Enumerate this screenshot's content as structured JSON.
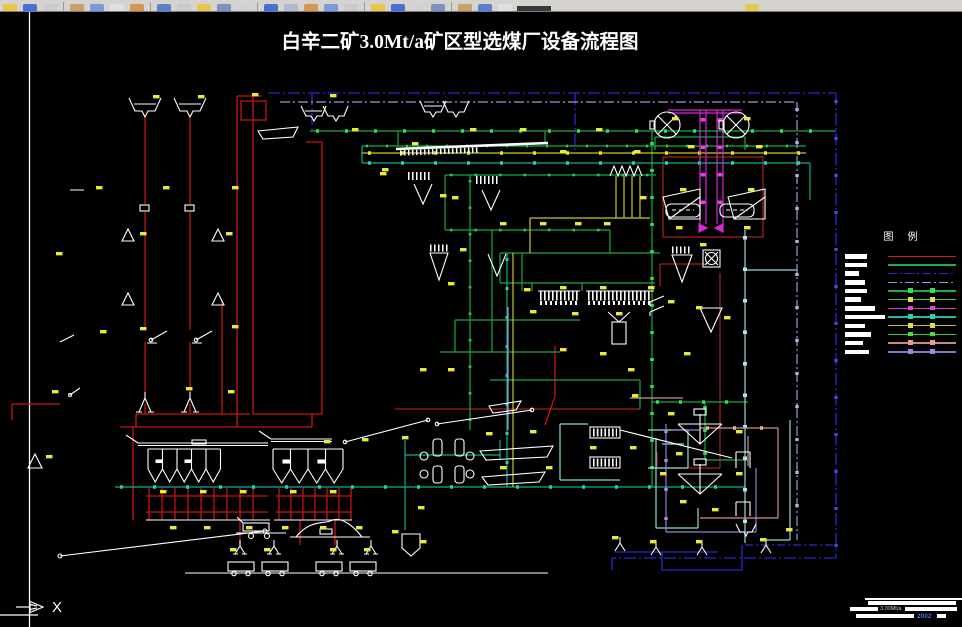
{
  "drawing": {
    "title": "白辛二矿3.0Mt/a矿区型选煤厂设备流程图",
    "ucs_x_label": "X",
    "legend": {
      "header": "图例",
      "items": [
        {
          "line_color": "#cc2222",
          "style": "solid",
          "marker_color": null,
          "bar_width": 22
        },
        {
          "line_color": "#22a944",
          "style": "solid",
          "marker_color": null,
          "bar_width": 22
        },
        {
          "line_color": "#2a2ac8",
          "style": "dashdot",
          "marker_color": null,
          "bar_width": 14
        },
        {
          "line_color": "#9a9ade",
          "style": "dashdot",
          "marker_color": null,
          "bar_width": 20
        },
        {
          "line_color": "#22a944",
          "style": "solid",
          "marker_color": "#2fe052",
          "bar_width": 22
        },
        {
          "line_color": "#66bb44",
          "style": "solid",
          "marker_color": "#dddd55",
          "bar_width": 16
        },
        {
          "line_color": "#bb44bb",
          "style": "solid",
          "marker_color": "#e040e0",
          "bar_width": 30
        },
        {
          "line_color": "#22bbaa",
          "style": "solid",
          "marker_color": "#33ccaa",
          "bar_width": 40
        },
        {
          "line_color": "#bbbb33",
          "style": "solid",
          "marker_color": "#dddd44",
          "bar_width": 20
        },
        {
          "line_color": "#44cc44",
          "style": "solid",
          "marker_color": "#44dd44",
          "bar_width": 26
        },
        {
          "line_color": "#cc8888",
          "style": "solid",
          "marker_color": "#ee9999",
          "bar_width": 18
        },
        {
          "line_color": "#8877cc",
          "style": "solid",
          "marker_color": "#9988dd",
          "bar_width": 24
        }
      ]
    },
    "title_block": {
      "line2_fragment": "3.00Mt/a",
      "line3_fragment": "2002"
    },
    "palette": {
      "canvas_bg": "#000000",
      "sheet_line": "#ffffff",
      "red": "#c81414",
      "dark_red": "#a02020",
      "green": "#16a93c",
      "bright_green": "#2fe052",
      "teal": "#0fae8e",
      "cyan": "#8fd8d8",
      "blue": "#2828c8",
      "lavender": "#9a9ade",
      "magenta": "#d628d6",
      "salmon": "#d89090",
      "purple": "#8f7fd0",
      "yellow": "#e9e93a",
      "white": "#ffffff",
      "toolbar_bg": "#d6d3ce"
    }
  }
}
